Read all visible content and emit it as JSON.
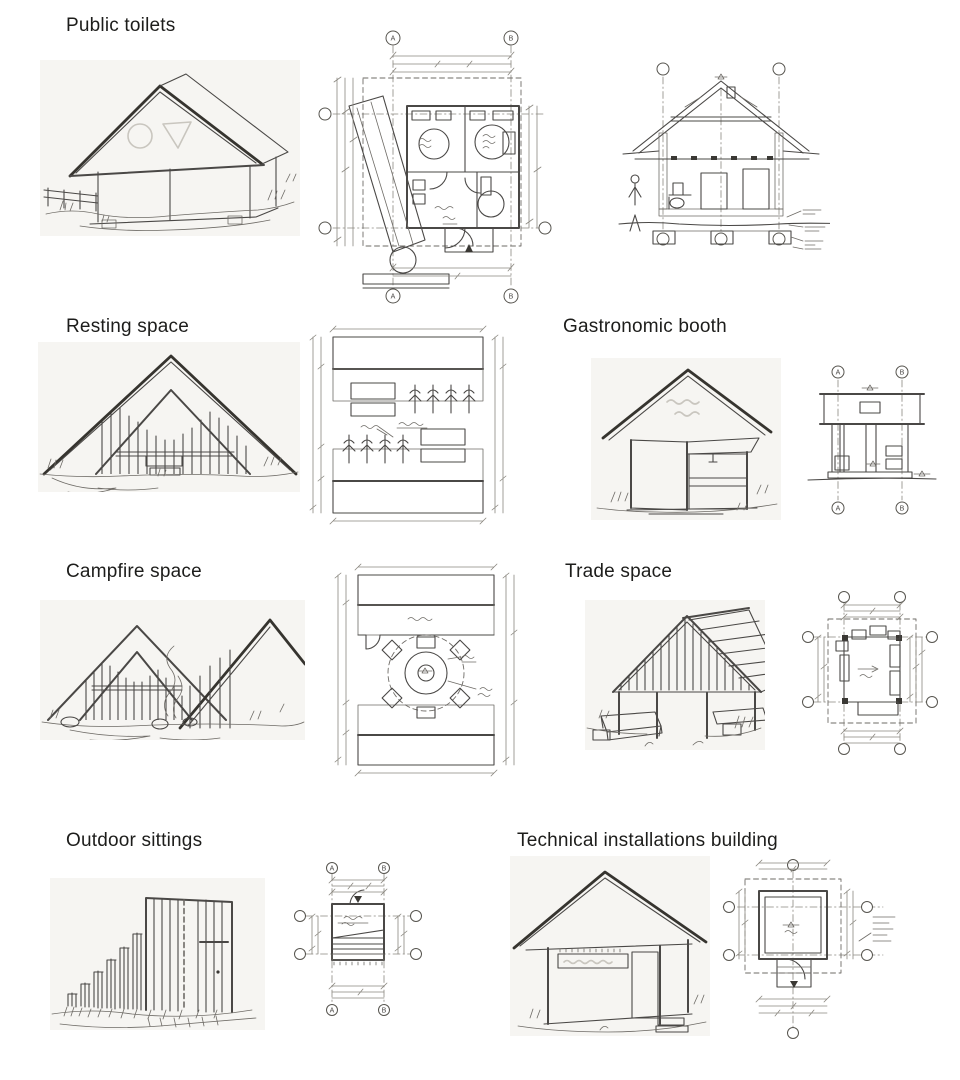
{
  "page": {
    "background": "#ffffff",
    "ink_color": "#4a4846",
    "label_color": "#1d1d1b",
    "paper_tint": "#f6f5f2"
  },
  "sections": [
    {
      "label": "Public toilets"
    },
    {
      "label": "Resting space"
    },
    {
      "label": "Gastronomic booth"
    },
    {
      "label": "Campfire space"
    },
    {
      "label": "Trade space"
    },
    {
      "label": "Outdoor sittings"
    },
    {
      "label": "Technical installations building"
    }
  ],
  "grid": {
    "a": "A",
    "b": "B"
  }
}
